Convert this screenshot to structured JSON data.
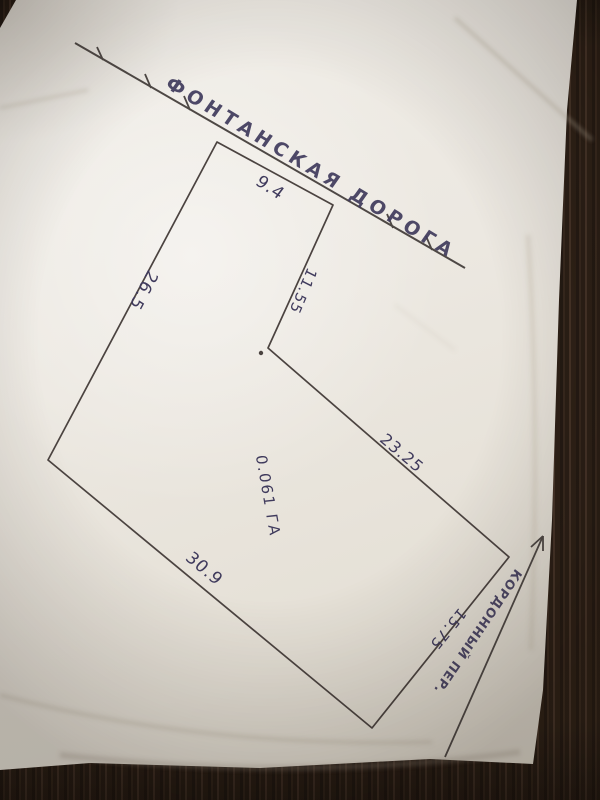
{
  "scene": {
    "description": "hand-drawn land plot sketch on white paper photographed on a dark wooden table",
    "colors": {
      "ink": "#3f3a5c",
      "pen_line": "#4b4340",
      "paper": "#ece8e1",
      "wood": "#2c2118"
    }
  },
  "roads": {
    "fontanskaya": {
      "label": "ФОНТАНСКАЯ ДОРОГА"
    },
    "kordonny": {
      "label": "КОРДОННЫЙ ПЕР."
    }
  },
  "plot": {
    "area_label": "0.061 ГА",
    "dimensions": {
      "top": "9.4",
      "notch": "11.55",
      "left": "26.5",
      "right_upper": "23.25",
      "bottom": "30.9",
      "right_lower": "15.75"
    }
  }
}
